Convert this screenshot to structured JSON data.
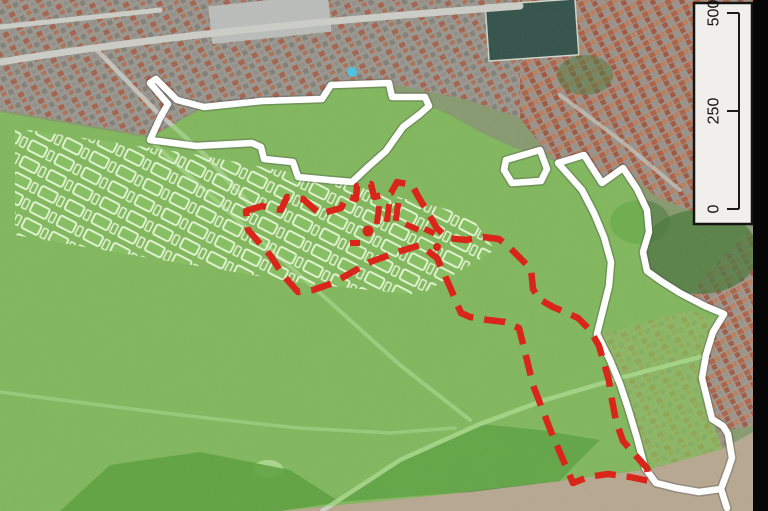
{
  "scalebar": {
    "labels": [
      "500",
      "250",
      "0"
    ]
  },
  "layers": {
    "green_overlay": {
      "label": "highlighted green area",
      "fill": "#7fd84f"
    },
    "white_boundary": {
      "label": "solid white boundary",
      "stroke": "#ffffff"
    },
    "red_boundary": {
      "label": "dashed red boundary",
      "stroke": "#da251b"
    }
  },
  "basemap": {
    "land": "#87986f",
    "urban": "#98968e",
    "urban_ne": "#9b9189",
    "river": "#b5a68f",
    "dark_vegetation": "#3f6b33",
    "frame_strip": "#060606"
  }
}
